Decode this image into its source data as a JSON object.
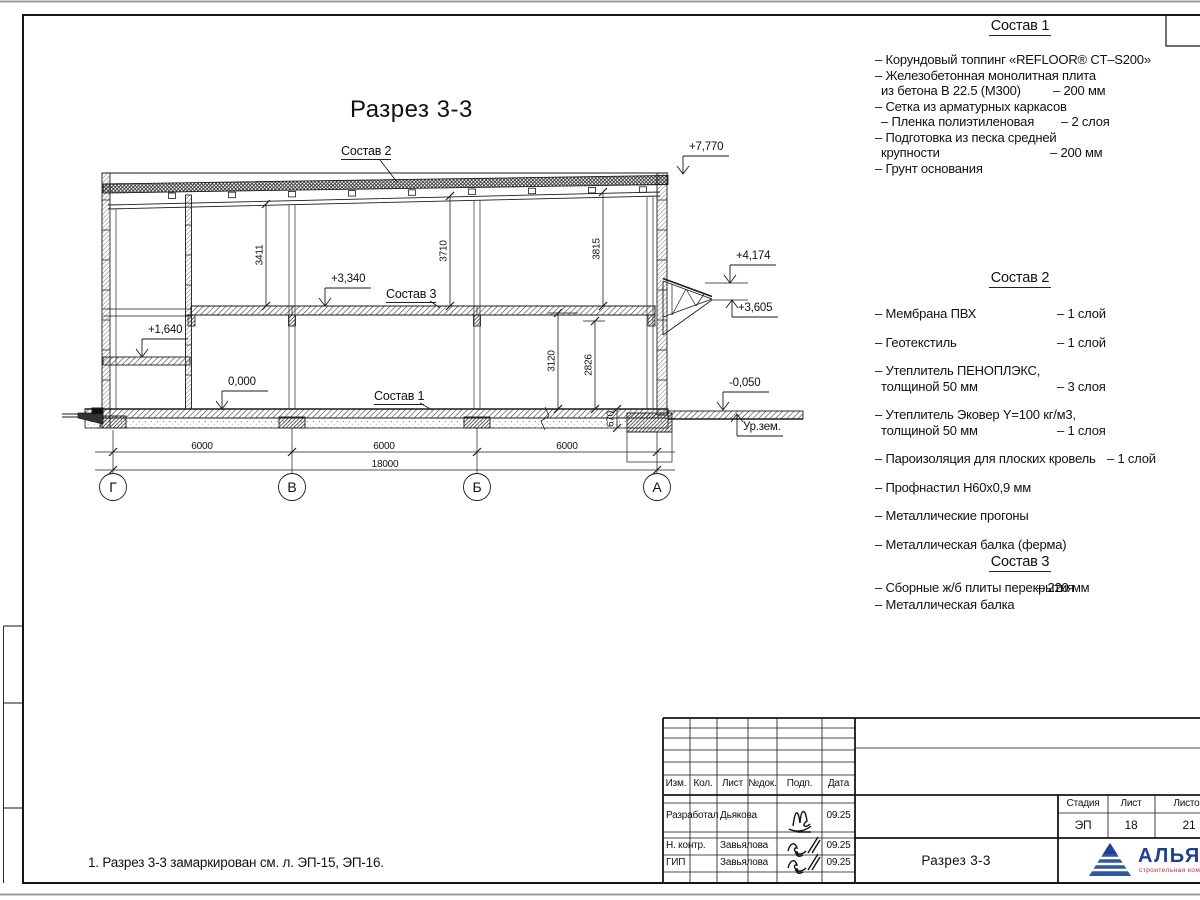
{
  "drawing": {
    "title": "Разрез 3-3",
    "grid_axes": [
      "Г",
      "В",
      "Б",
      "А"
    ],
    "dimensions": {
      "horizontal": [
        "6000",
        "6000",
        "6000",
        "18000"
      ],
      "vertical": [
        "3411",
        "3710",
        "3815",
        "3120",
        "2826",
        "670"
      ]
    },
    "elevations": [
      "+7,770",
      "+4,174",
      "+3,605",
      "+3,340",
      "+1,640",
      "0,000",
      "-0,050"
    ],
    "ground_label": "Ур.зем.",
    "leader_labels": [
      "Состав 2",
      "Состав 3",
      "Состав 1"
    ],
    "note": "1. Разрез 3-3 замаркирован см. л. ЭП-15, ЭП-16."
  },
  "legend": {
    "sections": [
      {
        "heading": "Состав 1",
        "items": [
          {
            "lines": [
              {
                "t": "– Корундовый топпинг «REFLOOR® CT–S200»",
                "v": null,
                "ind": 0
              }
            ]
          },
          {
            "lines": [
              {
                "t": "– Железобетонная  монолитная плита",
                "v": null,
                "ind": 0
              },
              {
                "t": "из бетона В 22.5 (М300)",
                "v": "– 200 мм",
                "ind": 1
              }
            ]
          },
          {
            "lines": [
              {
                "t": "– Сетка из арматурных каркасов",
                "v": null,
                "ind": 0
              }
            ]
          },
          {
            "lines": [
              {
                "t": "– Пленка полиэтиленовая",
                "v": "– 2 слоя",
                "ind": 1
              }
            ]
          },
          {
            "lines": [
              {
                "t": "– Подготовка из песка средней",
                "v": null,
                "ind": 0
              },
              {
                "t": "крупности",
                "v": "– 200 мм",
                "ind": 1
              }
            ]
          },
          {
            "lines": [
              {
                "t": "– Грунт основания",
                "v": null,
                "ind": 0
              }
            ]
          }
        ]
      },
      {
        "heading": "Состав 2",
        "items": [
          {
            "lines": [
              {
                "t": "– Мембрана ПВХ",
                "v": "– 1 слой",
                "ind": 0
              }
            ]
          },
          {
            "lines": [
              {
                "t": "– Геотекстиль",
                "v": "– 1 слой",
                "ind": 0
              }
            ]
          },
          {
            "lines": [
              {
                "t": "– Утеплитель ПЕНОПЛЭКС,",
                "v": null,
                "ind": 0
              },
              {
                "t": "толщиной 50 мм",
                "v": "– 3 слоя",
                "ind": 1
              }
            ]
          },
          {
            "lines": [
              {
                "t": "– Утеплитель Эковер Y=100 кг/м3,",
                "v": null,
                "ind": 0
              },
              {
                "t": "толщиной 50 мм",
                "v": "– 1 слоя",
                "ind": 1
              }
            ]
          },
          {
            "lines": [
              {
                "t": "– Пароизоляция для плоских кровель",
                "v": "– 1 слой",
                "ind": 0
              }
            ]
          },
          {
            "lines": [
              {
                "t": "– Профнастил Н60х0,9 мм",
                "v": null,
                "ind": 0
              }
            ]
          },
          {
            "lines": [
              {
                "t": "– Металлические прогоны",
                "v": null,
                "ind": 0
              }
            ]
          },
          {
            "lines": [
              {
                "t": "– Металлическая балка (ферма)",
                "v": null,
                "ind": 0
              }
            ]
          }
        ]
      },
      {
        "heading": "Состав 3",
        "items": [
          {
            "lines": [
              {
                "t": "– Сборные ж/б плиты перекрытия",
                "v": "– 220 мм",
                "ind": 0
              }
            ]
          },
          {
            "lines": [
              {
                "t": "– Металлическая балка",
                "v": null,
                "ind": 0
              }
            ]
          }
        ]
      }
    ]
  },
  "title_block": {
    "columns": [
      "Изм.",
      "Кол.",
      "Лист",
      "№док.",
      "Подп.",
      "Дата"
    ],
    "rows": [
      {
        "role": "Разработал",
        "name": "Дьякова",
        "date": "09.25"
      },
      {
        "role": "Н. контр.",
        "name": "Завьялова",
        "date": "09.25"
      },
      {
        "role": "ГИП",
        "name": "Завьялова",
        "date": "09.25"
      }
    ],
    "doc_title": "Разрез 3-3",
    "stage_label": "Стадия",
    "sheet_label": "Лист",
    "sheets_label": "Листов",
    "stage": "ЭП",
    "sheet": "18",
    "sheets": "21",
    "logo": {
      "name": "АЛЬЯНС",
      "tagline": "строительная компания",
      "color": "#1d3e9b",
      "accent": "#d62828"
    }
  }
}
